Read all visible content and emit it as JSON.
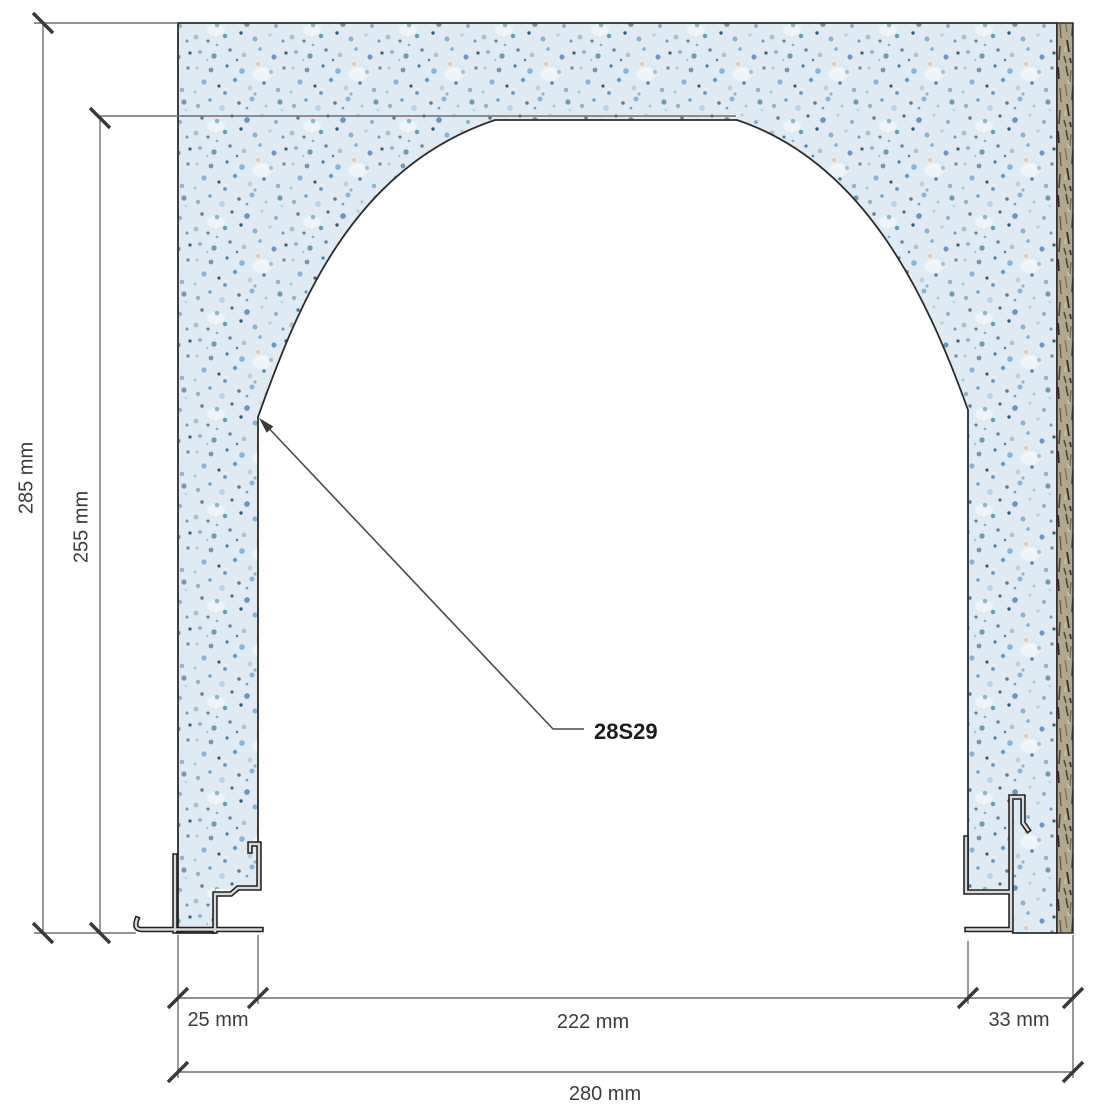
{
  "labels": {
    "height_total": "285 mm",
    "height_opening": "255 mm",
    "width_left_jamb": "25 mm",
    "width_opening": "222 mm",
    "width_right_jamb": "33 mm",
    "width_total": "280 mm",
    "part": "28S29"
  },
  "colors": {
    "panel_base": "#dfeaf2",
    "panel_speckle": "#6e98b6",
    "edge_strip": "#b1a78d",
    "outline": "#2b2b2b",
    "dimension_line": "#6e6e6e",
    "text": "#3c3c3c",
    "profile_fill": "#d9d9d9"
  }
}
